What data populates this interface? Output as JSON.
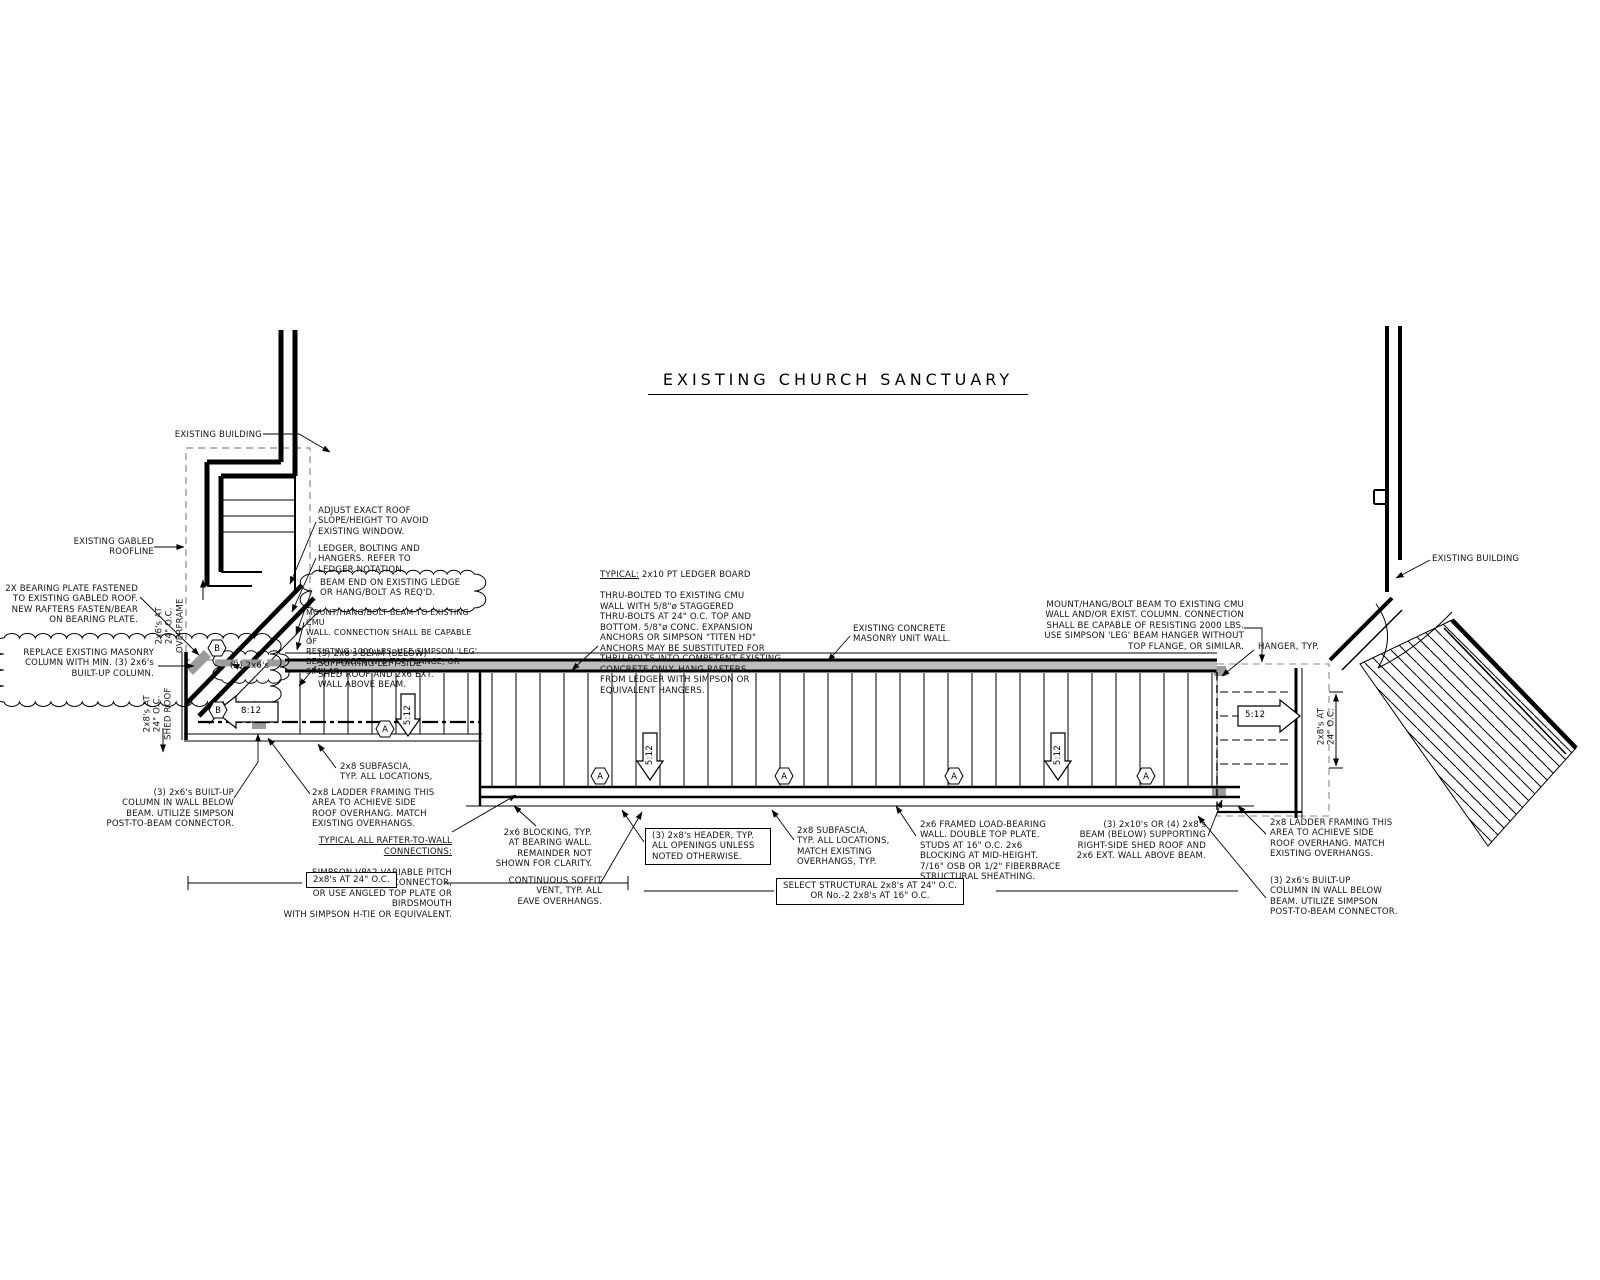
{
  "title": "EXISTING CHURCH SANCTUARY",
  "tags": {
    "a": "A",
    "b": "B"
  },
  "slopes": {
    "left": "8:12",
    "main": "5:12"
  },
  "dims": {
    "overframe": "2x6's AT\n24\" O.C.\nOVERFRAME",
    "shed_left": "2x8's AT\n24\" O.C.\nSHED ROOF",
    "shed_right": "2x8's AT\n24\" O.C.",
    "rafters_box": "2x8's AT 24\" O.C.",
    "select_structural": "SELECT STRUCTURAL 2x8's AT 24\" O.C.\nOR No.-2 2x8's AT 16\" O.C."
  },
  "notes": {
    "existing_building_left": {
      "text": "EXISTING BUILDING"
    },
    "existing_gabled_roofline": {
      "text": "EXISTING GABLED\nROOFLINE"
    },
    "bearing_plate": {
      "text": "2X BEARING PLATE FASTENED\nTO EXISTING GABLED ROOF.\nNEW RAFTERS FASTEN/BEAR\nON BEARING PLATE."
    },
    "replace_masonry_column": {
      "text": "REPLACE EXISTING MASONRY\nCOLUMN WITH MIN. (3) 2x6's\nBUILT-UP COLUMN."
    },
    "two_2x6s": {
      "text": "(2) 2x6's"
    },
    "adjust_roof": {
      "text": "ADJUST EXACT ROOF\nSLOPE/HEIGHT TO AVOID\nEXISTING WINDOW."
    },
    "ledger_bolting": {
      "text": "LEDGER, BOLTING AND\nHANGERS. REFER TO\nLEDGER NOTATION."
    },
    "beam_end_ledge": {
      "text": "BEAM END ON EXISTING LEDGE\nOR HANG/BOLT AS REQ'D."
    },
    "mount_beam_1000": {
      "text": "MOUNT/HANG/BOLT BEAM TO EXISTING CMU\nWALL. CONNECTION SHALL BE CAPABLE OF\nRESISTING 1000 LBS. USE SIMPSON 'LEG'\nBEAM HANGER W/O TOP FLANGE, OR SIMILAR."
    },
    "beam_below_left": {
      "text": "(3) 2x8's BEAM (BELOW)\nSUPPORTING LEFT-SIDE\nSHED ROOF AND 2x6 EXT.\nWALL ABOVE BEAM."
    },
    "builtup_column_left": {
      "text": "(3) 2x6's BUILT-UP\nCOLUMN IN WALL BELOW\nBEAM. UTILIZE SIMPSON\nPOST-TO-BEAM CONNECTOR."
    },
    "subfascia_left": {
      "text": "2x8 SUBFASCIA,\nTYP. ALL LOCATIONS,"
    },
    "ladder_framing_left": {
      "text": "2x8 LADDER FRAMING THIS\nAREA TO ACHIEVE SIDE\nROOF OVERHANG. MATCH\nEXISTING OVERHANGS."
    },
    "rafter_to_wall": {
      "heading": "TYPICAL ALL RAFTER-TO-WALL CONNECTIONS:",
      "body": "SIMPSON VPA2 VARIABLE PITCH CONNECTOR,\nOR USE ANGLED TOP PLATE OR BIRDSMOUTH\nWITH SIMPSON H-TIE OR EQUIVALENT."
    },
    "blocking": {
      "text": "2x6 BLOCKING, TYP.\nAT BEARING WALL.\nREMAINDER NOT\nSHOWN FOR CLARITY."
    },
    "soffit_vent": {
      "text": "CONTINUOUS SOFFIT\nVENT, TYP. ALL\nEAVE OVERHANGS."
    },
    "ledger_note": {
      "heading": "TYPICAL:",
      "line1": " 2x10 PT LEDGER BOARD",
      "body": "THRU-BOLTED TO EXISTING CMU\nWALL WITH 5/8\"ø STAGGERED\nTHRU-BOLTS AT 24\" O.C. TOP AND\nBOTTOM. 5/8\"ø CONC. EXPANSION\nANCHORS OR SIMPSON \"TITEN HD\"\nANCHORS MAY BE SUBSTITUTED FOR\nTHRU-BOLTS INTO COMPETENT EXISTING\nCONCRETE ONLY. HANG RAFTERS\nFROM LEDGER WITH SIMPSON OR\nEQUIVALENT HANGERS."
    },
    "cmu_wall": {
      "text": "EXISTING CONCRETE\nMASONRY UNIT WALL."
    },
    "header_typ": {
      "text": "(3) 2x8's HEADER, TYP.\nALL OPENINGS UNLESS\nNOTED OTHERWISE."
    },
    "subfascia_main": {
      "text": "2x8 SUBFASCIA,\nTYP. ALL LOCATIONS,\nMATCH EXISTING\nOVERHANGS, TYP."
    },
    "framed_wall": {
      "text": "2x6 FRAMED LOAD-BEARING\nWALL. DOUBLE TOP PLATE.\nSTUDS AT 16\" O.C. 2x6\nBLOCKING AT MID-HEIGHT.\n7/16\" OSB OR 1/2\" FIBERBRACE\nSTRUCTURAL SHEATHING."
    },
    "mount_beam_2000": {
      "text": "MOUNT/HANG/BOLT BEAM TO EXISTING CMU\nWALL AND/OR EXIST. COLUMN. CONNECTION\nSHALL BE CAPABLE OF RESISTING 2000 LBS.\nUSE SIMPSON 'LEG' BEAM HANGER WITHOUT\nTOP FLANGE, OR SIMILAR."
    },
    "hanger_typ": {
      "text": "HANGER, TYP."
    },
    "existing_building_right": {
      "text": "EXISTING BUILDING"
    },
    "beam_below_right": {
      "text": "(3) 2x10's OR (4) 2x8's\nBEAM (BELOW) SUPPORTING\nRIGHT-SIDE SHED ROOF AND\n2x6 EXT. WALL ABOVE BEAM."
    },
    "ladder_framing_right": {
      "text": "2x8 LADDER FRAMING THIS\nAREA TO ACHIEVE SIDE\nROOF OVERHANG. MATCH\nEXISTING OVERHANGS."
    },
    "builtup_column_right": {
      "text": "(3) 2x6's BUILT-UP\nCOLUMN IN WALL BELOW\nBEAM. UTILIZE SIMPSON\nPOST-TO-BEAM CONNECTOR."
    }
  }
}
